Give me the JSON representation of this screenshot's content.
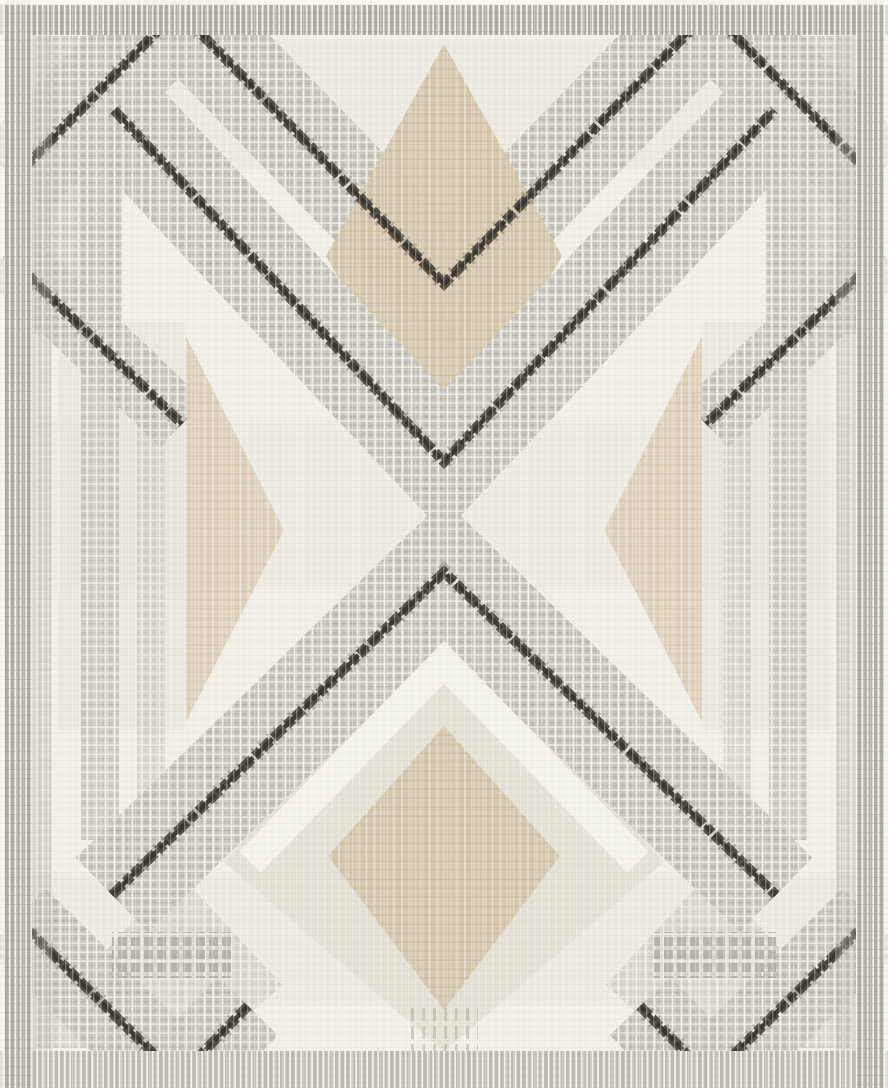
{
  "meta": {
    "alt": "Flat-weave area rug product photo: ivory ground with gray plaid chevron-diamond lattice, taupe diamonds, and dark charcoal ikat zigzag lines"
  },
  "rug": {
    "width": 888,
    "height": 1088,
    "palette": {
      "cream": "#f1efe6",
      "cream_deep": "#e3e1d6",
      "white": "#faf8f0",
      "pale_greige": "#e2dfd5",
      "plaid_base": "#c6c4bb",
      "plaid_dark": "#a9a79e",
      "plaid_white": "#f7f5ec",
      "border_gray": "#aeaca3",
      "border_gray_light": "#bcbab1",
      "tan": "#d5c6ac",
      "tan_dark": "#c3ae8f",
      "tan_pale": "#e6d9c3",
      "tan_light": "#decfb8",
      "charcoal": "#4a4339",
      "charcoal_deep": "#38332b"
    },
    "paths": {
      "w_top": [
        [
          14,
          178
        ],
        [
          178,
          10
        ],
        [
          444,
          284
        ],
        [
          710,
          10
        ],
        [
          874,
          178
        ]
      ],
      "v_mid": [
        [
          114,
          110
        ],
        [
          444,
          462
        ],
        [
          774,
          110
        ]
      ],
      "lam_mid": [
        [
          112,
          895
        ],
        [
          444,
          572
        ],
        [
          776,
          895
        ]
      ],
      "seg_l": [
        [
          6,
          254
        ],
        [
          182,
          424
        ]
      ],
      "seg_r": [
        [
          882,
          254
        ],
        [
          706,
          424
        ]
      ],
      "v_bl": [
        [
          16,
          918
        ],
        [
          178,
          1078
        ],
        [
          248,
          1006
        ]
      ],
      "v_br": [
        [
          872,
          918
        ],
        [
          710,
          1078
        ],
        [
          640,
          1006
        ]
      ],
      "chev_bot": [
        [
          250,
          862
        ],
        [
          444,
          662
        ],
        [
          638,
          862
        ]
      ]
    },
    "layers": [
      {
        "k": "rect",
        "n": "rug-field",
        "x": 0,
        "y": 0,
        "w": 888,
        "h": 1088,
        "f": "cream"
      },
      {
        "k": "rect",
        "n": "weft-tone-upper",
        "x": 0,
        "y": 40,
        "w": 888,
        "h": 130,
        "f": "cream_deep",
        "o": 0.35
      },
      {
        "k": "rect",
        "n": "weft-tone-center",
        "x": 0,
        "y": 420,
        "w": 888,
        "h": 170,
        "f": "cream_deep",
        "o": 0.28
      },
      {
        "k": "rect",
        "n": "weft-tone-lower",
        "x": 0,
        "y": 875,
        "w": 888,
        "h": 130,
        "f": "cream_deep",
        "o": 0.3
      },
      {
        "k": "poly",
        "n": "pale-diamond-bottom",
        "pts": [
          [
            444,
            618
          ],
          [
            664,
            862
          ],
          [
            444,
            1052
          ],
          [
            224,
            862
          ]
        ],
        "f": "pale_greige",
        "o": 0.9
      },
      {
        "k": "rect",
        "n": "pale-panel-left",
        "x": 58,
        "y": 322,
        "w": 128,
        "h": 408,
        "f": "pale_greige",
        "o": 0.45
      },
      {
        "k": "rect",
        "n": "pale-panel-right",
        "x": 702,
        "y": 322,
        "w": 128,
        "h": 408,
        "f": "pale_greige",
        "o": 0.45
      },
      {
        "k": "rect",
        "n": "plaid-block-top-left",
        "x": 30,
        "y": 148,
        "w": 92,
        "h": 186,
        "p": "plaid",
        "o": 0.8
      },
      {
        "k": "rect",
        "n": "plaid-block-top-right",
        "x": 766,
        "y": 148,
        "w": 92,
        "h": 186,
        "p": "plaid",
        "o": 0.8
      },
      {
        "k": "poly",
        "n": "plaid-corner-top-left",
        "pts": [
          [
            36,
            36
          ],
          [
            166,
            36
          ],
          [
            36,
            176
          ]
        ],
        "p": "plaid",
        "o": 0.75
      },
      {
        "k": "poly",
        "n": "plaid-corner-top-right",
        "pts": [
          [
            852,
            36
          ],
          [
            722,
            36
          ],
          [
            852,
            176
          ]
        ],
        "p": "plaid",
        "o": 0.75
      },
      {
        "k": "poly",
        "n": "plaid-corner-bottom-left",
        "pts": [
          [
            36,
            914
          ],
          [
            36,
            1048
          ],
          [
            160,
            1048
          ]
        ],
        "p": "plaid",
        "o": 0.6
      },
      {
        "k": "poly",
        "n": "plaid-corner-bottom-right",
        "pts": [
          [
            852,
            914
          ],
          [
            852,
            1048
          ],
          [
            728,
            1048
          ]
        ],
        "p": "plaid",
        "o": 0.6
      },
      {
        "k": "poly",
        "n": "plaid-diamond-bottom-left",
        "pts": [
          [
            178,
            872
          ],
          [
            282,
            985
          ],
          [
            178,
            1078
          ],
          [
            74,
            985
          ]
        ],
        "p": "plaid",
        "o": 0.55
      },
      {
        "k": "poly",
        "n": "plaid-diamond-bottom-right",
        "pts": [
          [
            710,
            872
          ],
          [
            814,
            985
          ],
          [
            710,
            1078
          ],
          [
            606,
            985
          ]
        ],
        "p": "plaid",
        "o": 0.55
      },
      {
        "k": "band",
        "n": "plaid-chevron-top",
        "path": "w_top",
        "wd": 96,
        "p": "plaid"
      },
      {
        "k": "band",
        "n": "plaid-seg-left",
        "path": "seg_l",
        "wd": 64,
        "p": "plaid",
        "o": 0.95
      },
      {
        "k": "band",
        "n": "plaid-seg-right",
        "path": "seg_r",
        "wd": 64,
        "p": "plaid",
        "o": 0.95
      },
      {
        "k": "band",
        "n": "plaid-column-left-inner",
        "pts": [
          [
            100,
            162
          ],
          [
            100,
            840
          ]
        ],
        "wd": 38,
        "p": "plaid",
        "o": 0.8
      },
      {
        "k": "band",
        "n": "plaid-column-left-mid",
        "pts": [
          [
            151,
            396
          ],
          [
            151,
            822
          ]
        ],
        "wd": 28,
        "p": "plaid",
        "o": 0.55
      },
      {
        "k": "band",
        "n": "stripe-column-left-edge",
        "pts": [
          [
            44,
            120
          ],
          [
            44,
            1048
          ]
        ],
        "wd": 14,
        "p": "plaid",
        "o": 0.4
      },
      {
        "k": "band",
        "n": "plaid-column-right-inner",
        "pts": [
          [
            788,
            162
          ],
          [
            788,
            840
          ]
        ],
        "wd": 38,
        "p": "plaid",
        "o": 0.8
      },
      {
        "k": "band",
        "n": "plaid-column-right-mid",
        "pts": [
          [
            737,
            396
          ],
          [
            737,
            822
          ]
        ],
        "wd": 28,
        "p": "plaid",
        "o": 0.55
      },
      {
        "k": "band",
        "n": "stripe-column-right-edge",
        "pts": [
          [
            844,
            120
          ],
          [
            844,
            1048
          ]
        ],
        "wd": 14,
        "p": "plaid",
        "o": 0.4
      },
      {
        "k": "poly",
        "n": "tan-diamond-top",
        "pts": [
          [
            444,
            44
          ],
          [
            562,
            256
          ],
          [
            444,
            468
          ],
          [
            326,
            256
          ]
        ],
        "p": "tanp",
        "o": 0.96
      },
      {
        "k": "band",
        "n": "plaid-chevron-mid",
        "path": "v_mid",
        "wd": 98,
        "p": "plaid"
      },
      {
        "k": "band",
        "n": "plaid-chevron-mid-lower",
        "path": "lam_mid",
        "wd": 104,
        "p": "plaid"
      },
      {
        "k": "band",
        "n": "plaid-v-bottom-left",
        "path": "v_bl",
        "wd": 84,
        "p": "plaid"
      },
      {
        "k": "band",
        "n": "plaid-v-bottom-right",
        "path": "v_br",
        "wd": 84,
        "p": "plaid"
      },
      {
        "k": "band",
        "n": "cream-chevron-bottom",
        "path": "chev_bot",
        "wd": 30,
        "c": "white",
        "o": 0.75
      },
      {
        "k": "poly",
        "n": "tan-diamond-bottom",
        "pts": [
          [
            444,
            726
          ],
          [
            560,
            856
          ],
          [
            444,
            1010
          ],
          [
            328,
            856
          ]
        ],
        "p": "tanp",
        "o": 0.96
      },
      {
        "k": "poly",
        "n": "tan-triangle-left",
        "pts": [
          [
            186,
            336
          ],
          [
            284,
            530
          ],
          [
            186,
            722
          ]
        ],
        "p": "tanlightp",
        "o": 0.92
      },
      {
        "k": "poly",
        "n": "tan-triangle-right",
        "pts": [
          [
            702,
            336
          ],
          [
            604,
            530
          ],
          [
            702,
            722
          ]
        ],
        "p": "tanlightp",
        "o": 0.92
      },
      {
        "k": "rect",
        "n": "dot-row-left",
        "x": 112,
        "y": 932,
        "w": 122,
        "h": 46,
        "p": "dots",
        "o": 0.85
      },
      {
        "k": "rect",
        "n": "dot-row-right",
        "x": 654,
        "y": 932,
        "w": 122,
        "h": 46,
        "p": "dots",
        "o": 0.85
      },
      {
        "k": "rect",
        "n": "ikat-drips-bottom",
        "x": 410,
        "y": 1004,
        "w": 68,
        "h": 60,
        "p": "drip",
        "o": 0.5
      },
      {
        "k": "dark",
        "n": "dark-zigzag-top",
        "path": "w_top"
      },
      {
        "k": "dark",
        "n": "dark-v-center",
        "path": "v_mid"
      },
      {
        "k": "dark",
        "n": "dark-lambda-center",
        "path": "lam_mid"
      },
      {
        "k": "dark",
        "n": "dark-seg-left",
        "path": "seg_l"
      },
      {
        "k": "dark",
        "n": "dark-seg-right",
        "path": "seg_r"
      },
      {
        "k": "dark",
        "n": "dark-v-bottom-left",
        "path": "v_bl"
      },
      {
        "k": "dark",
        "n": "dark-v-bottom-right",
        "path": "v_br"
      },
      {
        "k": "rect",
        "n": "border-top",
        "x": 0,
        "y": 5,
        "w": 888,
        "h": 30,
        "p": "stripe"
      },
      {
        "k": "rect",
        "n": "border-bottom",
        "x": 0,
        "y": 1051,
        "w": 888,
        "h": 37,
        "p": "stripe_light"
      },
      {
        "k": "rect",
        "n": "border-left",
        "x": 4,
        "y": 0,
        "w": 28,
        "h": 1088,
        "p": "stripe"
      },
      {
        "k": "rect",
        "n": "border-right",
        "x": 856,
        "y": 0,
        "w": 28,
        "h": 1088,
        "p": "stripe"
      },
      {
        "k": "rect",
        "n": "border-accent-left",
        "x": 32,
        "y": 35,
        "w": 20,
        "h": 1016,
        "p": "stripe",
        "o": 0.35
      },
      {
        "k": "rect",
        "n": "border-accent-right",
        "x": 836,
        "y": 35,
        "w": 20,
        "h": 1016,
        "p": "stripe",
        "o": 0.35
      },
      {
        "k": "rect",
        "n": "edge-top",
        "x": 0,
        "y": 0,
        "w": 888,
        "h": 5,
        "f": "white",
        "o": 0.85
      },
      {
        "k": "rect",
        "n": "edge-left",
        "x": 0,
        "y": 0,
        "w": 4,
        "h": 1088,
        "f": "white",
        "o": 0.6
      },
      {
        "k": "rect",
        "n": "edge-right",
        "x": 884,
        "y": 0,
        "w": 4,
        "h": 1088,
        "f": "white",
        "o": 0.6
      },
      {
        "k": "rect",
        "n": "weave-overlay",
        "x": 0,
        "y": 0,
        "w": 888,
        "h": 1088,
        "p": "weave"
      }
    ]
  }
}
